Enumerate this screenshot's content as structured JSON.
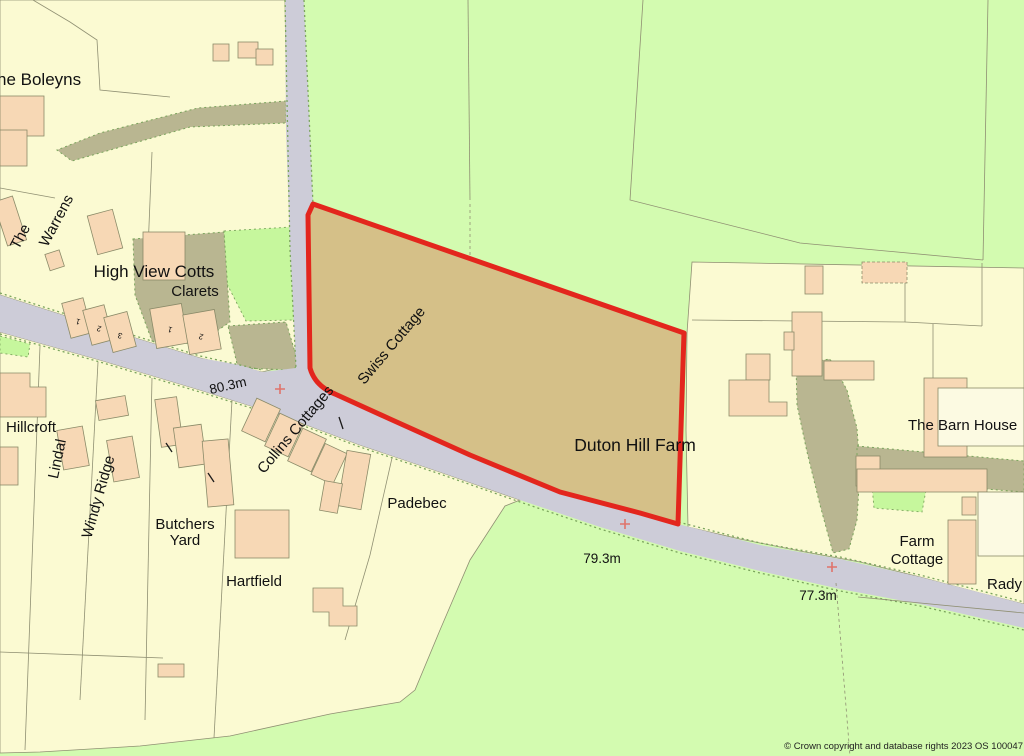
{
  "map": {
    "colors": {
      "field": "#d3fbb0",
      "parcel": "#fbfad2",
      "garden": "#c6f79d",
      "building": "#f7d8b5",
      "building_outline": "#8a8a68",
      "road": "#cdccd8",
      "drive": "#b9b691",
      "boundary_line": "#8f8f72",
      "road_dots": "#7aa45c",
      "plot_fill": "#d5c088",
      "plot_outline": "#e3261d",
      "marker": "#e0736b",
      "text": "#111111"
    },
    "labels": {
      "boleyns": "he Boleyns",
      "the": "The",
      "warrens": "Warrens",
      "high_view_cotts": "High View Cotts",
      "clarets": "Clarets",
      "hillcroft": "Hillcroft",
      "lindal": "Lindal",
      "windy_ridge": "Windy Ridge",
      "butchers": "Butchers",
      "yard": "Yard",
      "hartfield": "Hartfield",
      "padebec": "Padebec",
      "collins_cottages": "Collins Cottages",
      "swiss_cottage": "Swiss Cottage",
      "duton_hill_farm": "Duton Hill Farm",
      "the_barn_house": "The Barn House",
      "farm": "Farm",
      "cottage": "Cottage",
      "rady": "Rady"
    },
    "elevations": {
      "a": "80.3m",
      "b": "79.3m",
      "c": "77.3m"
    },
    "house_numbers": {
      "hv1": "1",
      "hv2": "2",
      "hv3": "3",
      "cl1": "1",
      "cl2": "2"
    },
    "copyright": "© Crown copyright and database rights 2023 OS 100047"
  }
}
